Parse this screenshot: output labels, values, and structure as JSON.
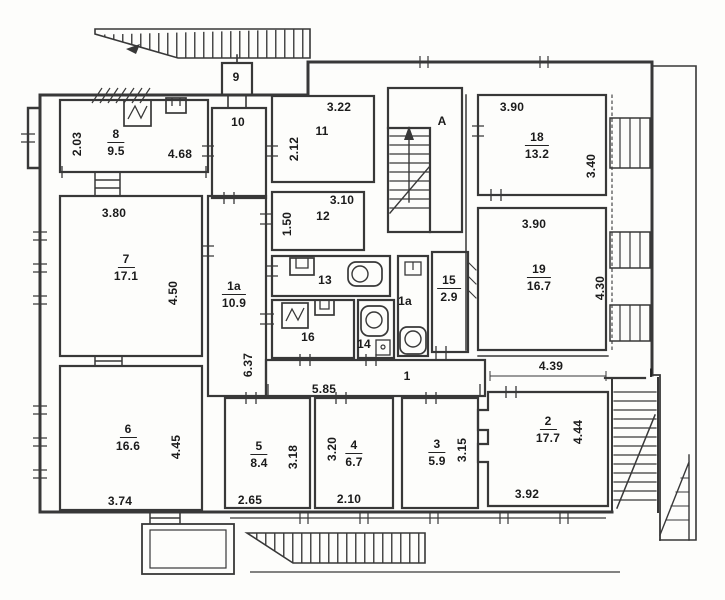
{
  "colors": {
    "ink": "#383838",
    "paper": "#fdfdfb"
  },
  "stairwells": {
    "a": "A",
    "i": "I"
  },
  "rooms": {
    "r1": {
      "num": "1",
      "len": "5.85"
    },
    "r1a_corridor": {
      "num": "1a",
      "area": "10.9",
      "len": "6.37"
    },
    "r1a_lobby": {
      "num": "1a"
    },
    "r2": {
      "num": "2",
      "area": "17.7",
      "h": "4.44",
      "w_top": "4.39",
      "w_bottom": "3.92"
    },
    "r3": {
      "num": "3",
      "area": "5.9",
      "h": "3.15"
    },
    "r4": {
      "num": "4",
      "area": "6.7",
      "h": "3.20",
      "w": "2.10"
    },
    "r5": {
      "num": "5",
      "area": "8.4",
      "h": "3.18",
      "w": "2.65"
    },
    "r6": {
      "num": "6",
      "area": "16.6",
      "h": "4.45",
      "w": "3.74"
    },
    "r7": {
      "num": "7",
      "area": "17.1",
      "w": "3.80",
      "h": "4.50"
    },
    "r8": {
      "num": "8",
      "area": "9.5",
      "w": "4.68",
      "h": "2.03"
    },
    "r9": {
      "num": "9"
    },
    "r10": {
      "num": "10"
    },
    "r11": {
      "num": "11",
      "w": "3.22",
      "h": "2.12"
    },
    "r12": {
      "num": "12",
      "w": "3.10",
      "h": "1.50"
    },
    "r13": {
      "num": "13"
    },
    "r14": {
      "num": "14"
    },
    "r15": {
      "num": "15",
      "area": "2.9"
    },
    "r16": {
      "num": "16"
    },
    "r18": {
      "num": "18",
      "area": "13.2",
      "w": "3.90",
      "h": "3.40"
    },
    "r19": {
      "num": "19",
      "area": "16.7",
      "w": "3.90",
      "h": "4.30"
    }
  }
}
